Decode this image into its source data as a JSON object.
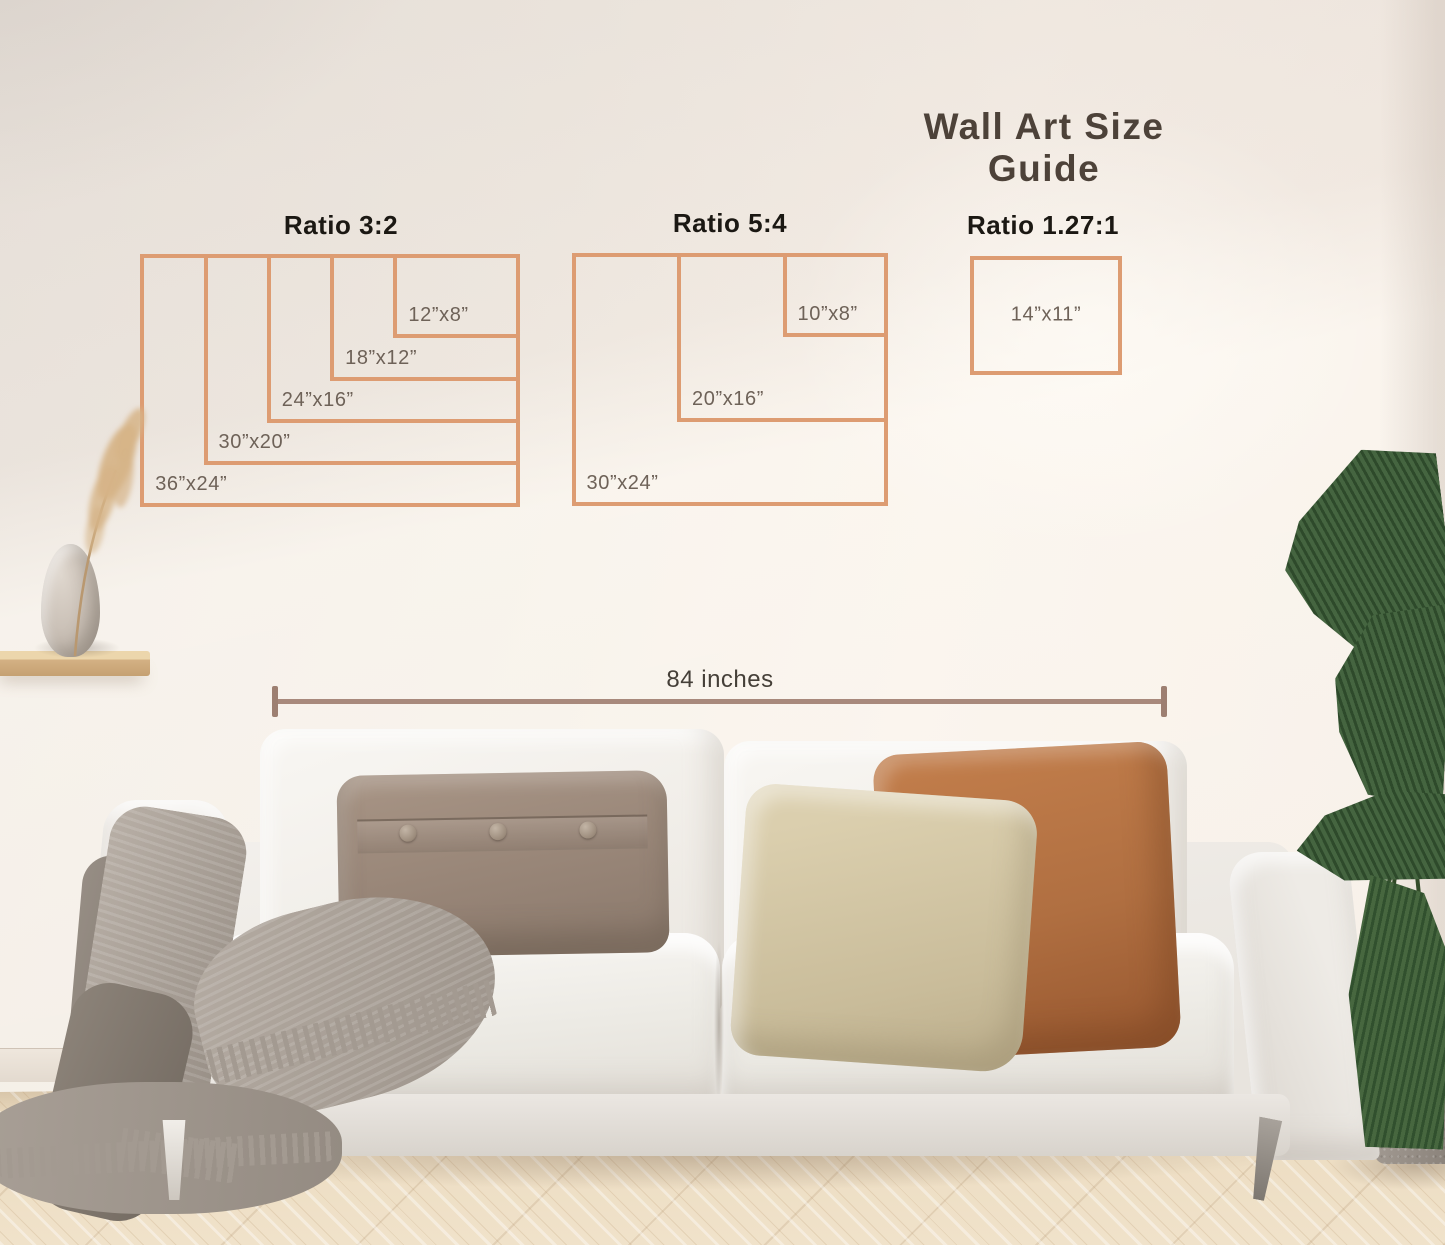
{
  "page": {
    "title": "Wall Art Size Guide"
  },
  "guide": {
    "border_color": "#dd9c72",
    "label_color": "#6e6258",
    "ratio_title_color": "#1b1813",
    "groups": [
      {
        "title": "Ratio 3:2",
        "title_cx": 341,
        "title_y": 210,
        "anchor_right": 520,
        "anchor_top": 254,
        "scale": 10.55,
        "label_pos": "bottom-left",
        "sizes": [
          {
            "label": "36”x24”",
            "w_in": 36,
            "h_in": 24
          },
          {
            "label": "30”x20”",
            "w_in": 30,
            "h_in": 20
          },
          {
            "label": "24”x16”",
            "w_in": 24,
            "h_in": 16
          },
          {
            "label": "18”x12”",
            "w_in": 18,
            "h_in": 12
          },
          {
            "label": "12”x8”",
            "w_in": 12,
            "h_in": 8
          }
        ]
      },
      {
        "title": "Ratio 5:4",
        "title_cx": 730,
        "title_y": 208,
        "anchor_right": 888,
        "anchor_top": 253,
        "scale": 10.55,
        "label_pos": "bottom-left",
        "sizes": [
          {
            "label": "30”x24”",
            "w_in": 30,
            "h_in": 24
          },
          {
            "label": "20”x16”",
            "w_in": 20,
            "h_in": 16
          },
          {
            "label": "10”x8”",
            "w_in": 10,
            "h_in": 8
          }
        ]
      },
      {
        "title": "Ratio 1.27:1",
        "title_cx": 1043,
        "title_y": 210,
        "anchor_right": 1122,
        "anchor_top": 256,
        "scale": 10.85,
        "label_pos": "center",
        "sizes": [
          {
            "label": "14”x11”",
            "w_in": 14,
            "h_in": 11
          }
        ]
      }
    ]
  },
  "measurement": {
    "label": "84 inches",
    "color": "#a8897c"
  },
  "scene": {
    "wall_color": "#f2eae2",
    "floor_color": "#e9d8bd",
    "sofa_color": "#f2f0ec",
    "pillow_colors": {
      "left": "#9a8779",
      "middle": "#d2c5a4",
      "right": "#b06f43"
    },
    "blanket_color": "#a49b92",
    "plant_color": "#3c5a38",
    "pot_color": "#9b938b",
    "vase_color": "#cfc6bc",
    "shelf_color": "#d5b488",
    "pampas_color": "#d4b384"
  }
}
